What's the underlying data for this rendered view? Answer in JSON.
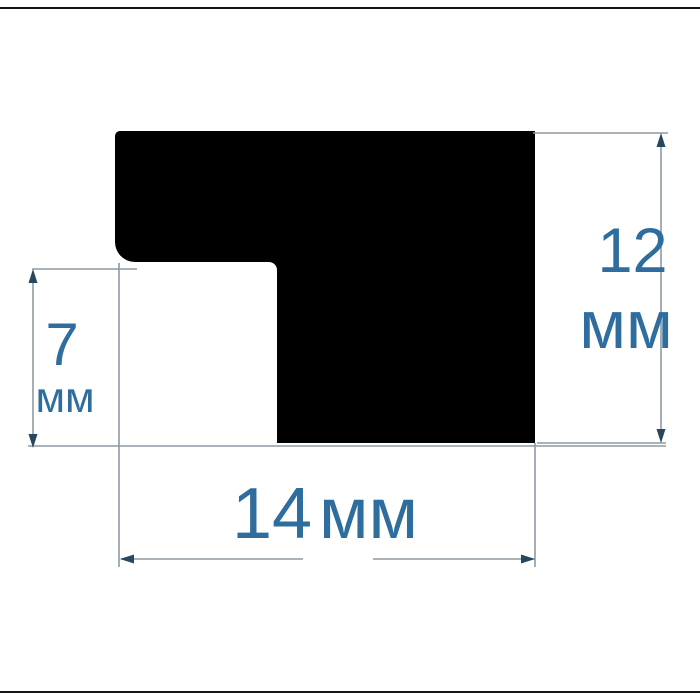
{
  "diagram": {
    "kind": "profile-cross-section-dimension-drawing",
    "labels": {
      "height": {
        "value": "12",
        "unit": "мм"
      },
      "inner_height": {
        "value": "7",
        "unit": "мм"
      },
      "width": {
        "value": "14",
        "unit": "мм"
      }
    },
    "colors": {
      "background": "#ffffff",
      "shape": "#000000",
      "dimension_line": "#8e9aa2",
      "arrow": "#28465c",
      "text": "#2e6d9e",
      "border_line": "#141414"
    }
  }
}
